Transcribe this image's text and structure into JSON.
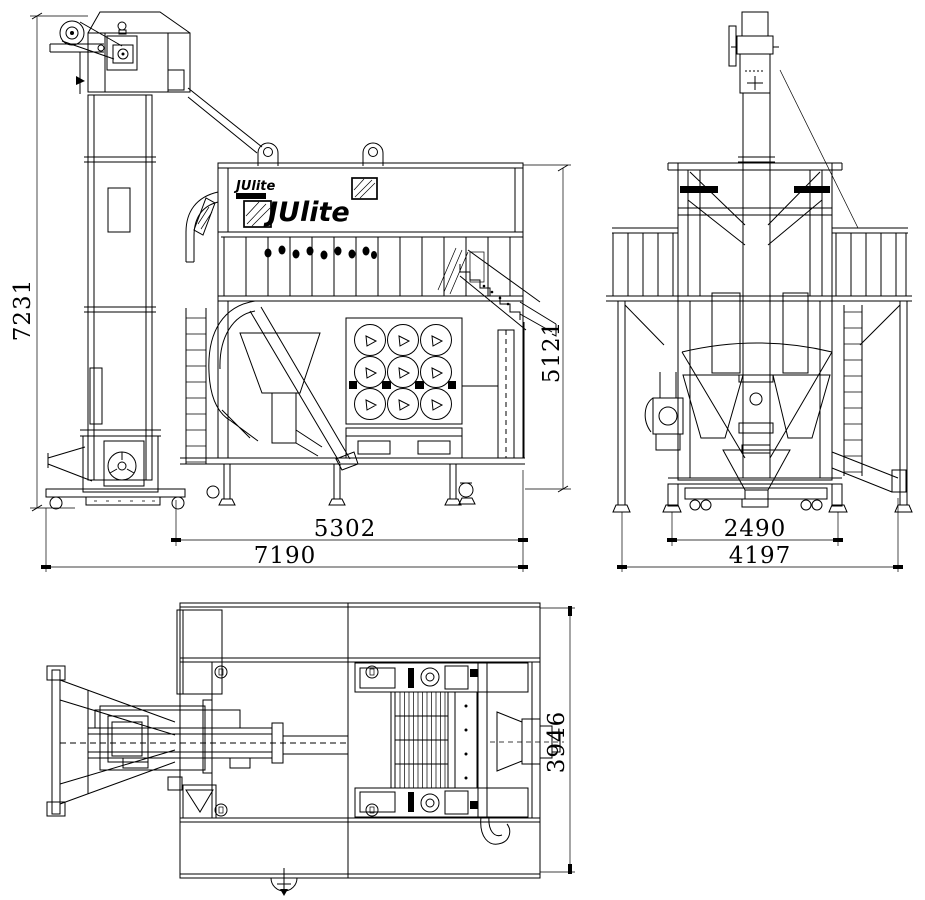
{
  "drawing": {
    "brand": {
      "logo_large": "JUlite",
      "logo_small": "JUlite"
    },
    "dimensions": {
      "front_overall_height": "7231",
      "front_body_height": "5121",
      "front_body_width": "5302",
      "front_overall_width": "7190",
      "side_base_width": "2490",
      "side_overall_width": "4197",
      "plan_overall_depth": "3946"
    },
    "colors": {
      "line": "#000000",
      "background": "#ffffff"
    }
  }
}
